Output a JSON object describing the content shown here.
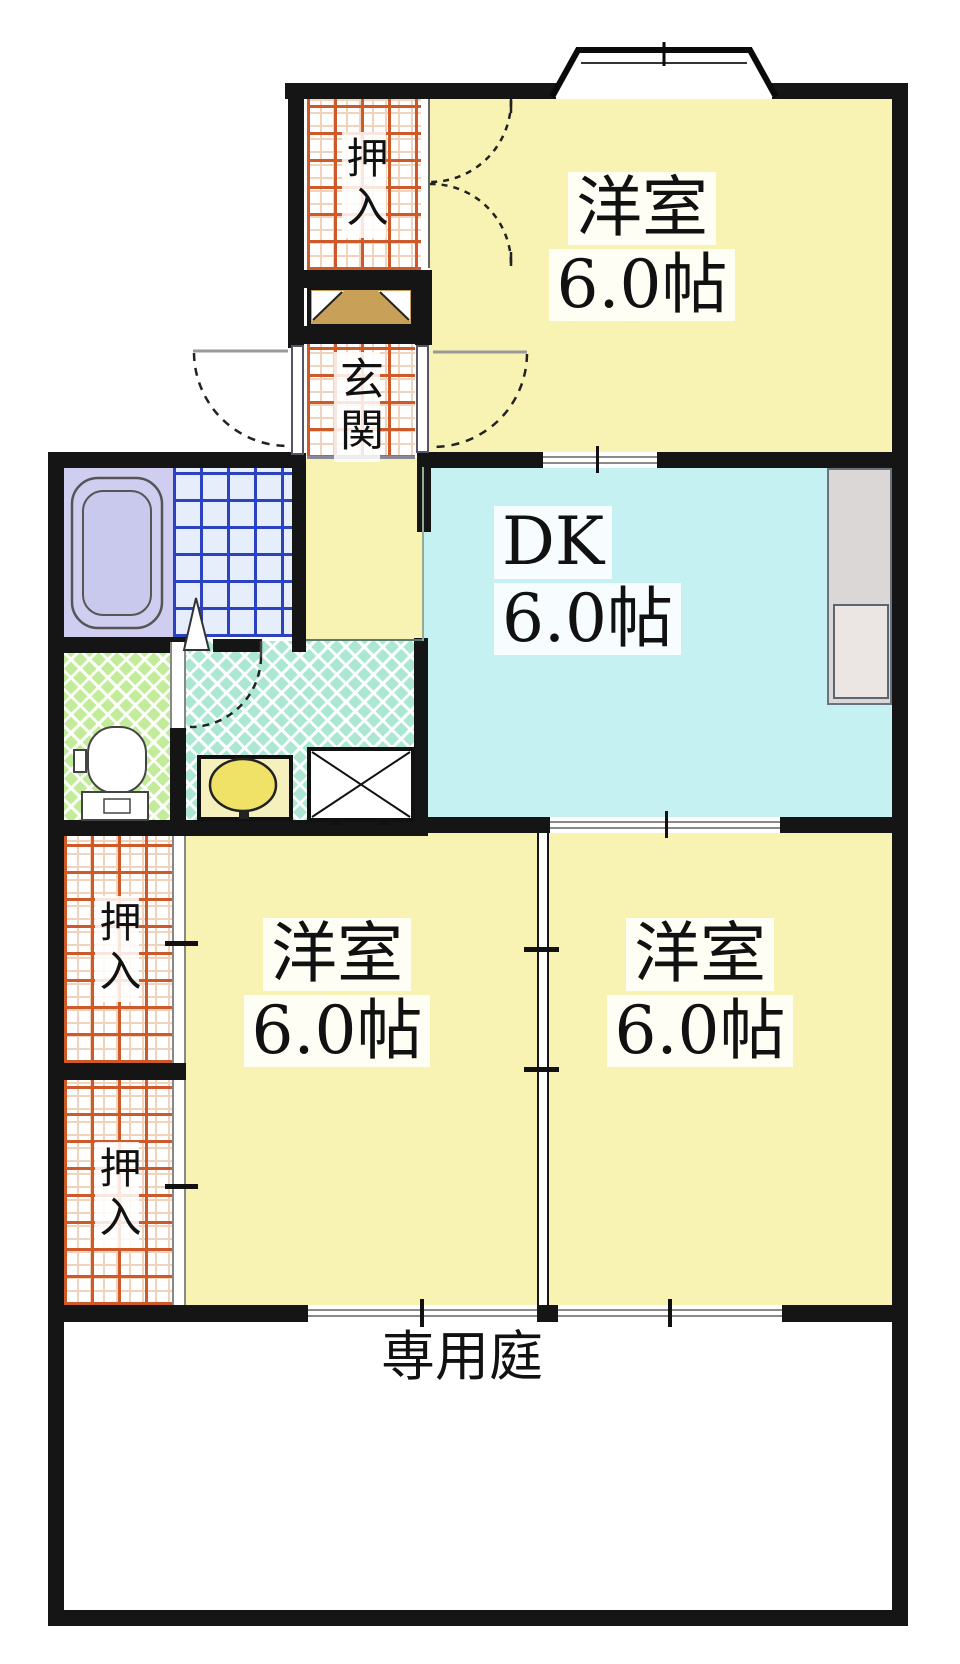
{
  "plan": {
    "rooms": {
      "western_top": {
        "label": "洋室",
        "size": "6.0帖"
      },
      "dining_kitchen": {
        "label": "DK",
        "size": "6.0帖"
      },
      "western_sw": {
        "label": "洋室",
        "size": "6.0帖"
      },
      "western_se": {
        "label": "洋室",
        "size": "6.0帖"
      },
      "garden": {
        "label": "専用庭"
      },
      "entrance": {
        "label": "玄関"
      },
      "closet_top": {
        "label": "押入"
      },
      "closet_mid": {
        "label": "押入"
      },
      "closet_bottom": {
        "label": "押入"
      }
    },
    "colors": {
      "wall": "#151515",
      "room-yellow": "#f8f3b2",
      "dk-cyan": "#c6f1f3",
      "bath-lavender": "#cfcef1",
      "tile-blue-line": "#2b43c0",
      "tile-red-line": "#cd5a28",
      "toilet-green": "#c2ec9a",
      "washroom-teal": "#abe7d3",
      "shoe-cabinet-tan": "#c8a058",
      "counter-gray": "#dbd7d7",
      "sink-yellow": "#f0e266",
      "garden-white": "#ffffff"
    }
  }
}
